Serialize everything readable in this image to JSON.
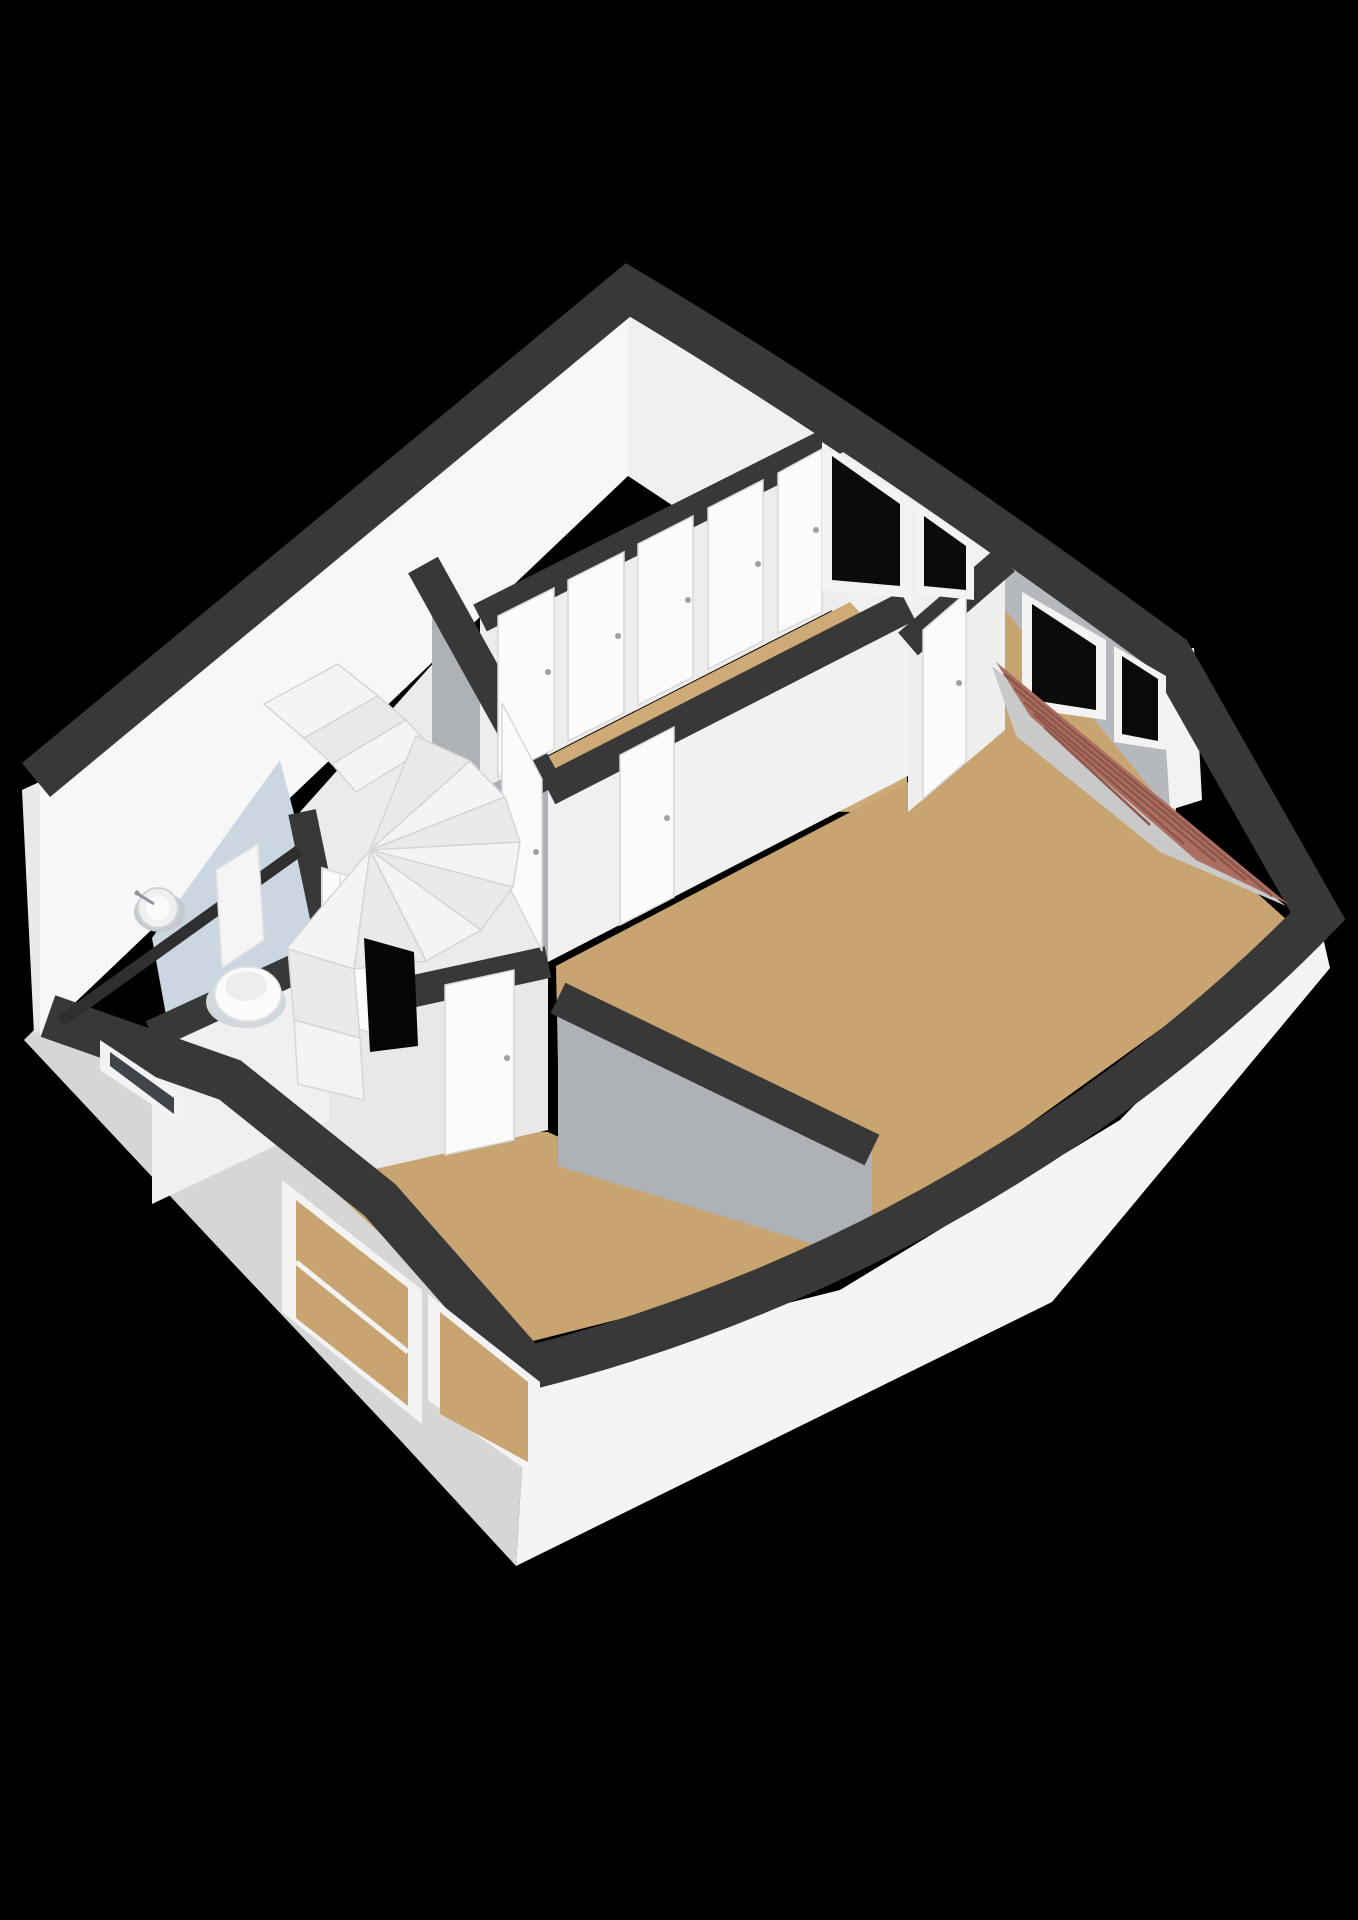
{
  "meta": {
    "type": "3d-floorplan-isometric-render",
    "background": "#000000",
    "floor_label": "upper floor (stairs, landing, bedrooms, toilet)",
    "rooms": [
      {
        "name": "hallway-landing",
        "floor_color": "#cdaa76"
      },
      {
        "name": "ne-bedroom",
        "floor_color": "#c8a470"
      },
      {
        "name": "east-bedroom",
        "floor_color": "#c8a470"
      },
      {
        "name": "south-bedroom",
        "floor_color": "#c8a470"
      },
      {
        "name": "stair-room",
        "floor_color": "#ebebeb"
      },
      {
        "name": "toilet-room",
        "floor_color": "#ccd6e0"
      }
    ],
    "fixtures": [
      "winder-staircase",
      "stairwell-opening",
      "toilet",
      "wall-basin",
      "roof-slope-tiles"
    ],
    "palette": {
      "wall_top_band": "#383838",
      "interior_wall_white": "#f7f7f7",
      "interior_wall_gray": "#aeb1b6",
      "exterior_wall_light": "#d6d6d6",
      "exterior_wall_white": "#f4f4f4",
      "floor_wood": "#c8a470",
      "floor_bath": "#ccd6e0",
      "window_pane": "#0b0b0b",
      "window_frame": "#f3f3f3",
      "roof_tiles": "#ab6e61",
      "roof_tile_line": "#8e564b",
      "door_white": "#fbfbfb",
      "handle_gray": "#9aa0a4"
    }
  },
  "scene": {
    "width": 1358,
    "height": 1920,
    "shapes": [
      {
        "n": "exterior-wall-sw-face",
        "t": "p",
        "f": "#d6d6d6",
        "d": "48,1016 230,1080 380,1200 528,1368 516,1566 400,1440 230,1260 24,1040"
      },
      {
        "n": "exterior-wall-se-face",
        "t": "p",
        "f": "#f4f4f4",
        "d": "528,1368 840,1290 1120,1120 1318,916 1330,968 1052,1302 516,1566"
      },
      {
        "n": "west-corner-wall-cap",
        "t": "p",
        "f": "#e9e9e9",
        "d": "22,790 48,778 62,1018 34,1034"
      },
      {
        "n": "nw-wall-interior-face",
        "t": "p",
        "f": "#f7f7f7",
        "d": "628,300 40,786 40,1036 628,476"
      },
      {
        "n": "ne-wall-interior-face-hall",
        "t": "p",
        "f": "#f0f0f1",
        "d": "628,300 1000,548 1000,722 628,476"
      },
      {
        "n": "ne-wall-interior-face-east-room",
        "t": "p",
        "f": "#b5b8bc",
        "d": "1000,548 1176,660 1176,818 1000,722"
      },
      {
        "n": "east-jut-wall-cap",
        "t": "p",
        "f": "#f2f2f2",
        "d": "1160,650 1194,648 1202,800 1170,810"
      },
      {
        "n": "floor-hallway",
        "t": "p",
        "f": "#cdaa76",
        "d": "482,790 850,602 903,658 908,814 548,802 440,650"
      },
      {
        "n": "floor-ne-bedroom",
        "t": "p",
        "f": "#c8a470",
        "d": "916,662 1002,606 1176,820 1080,880 916,820"
      },
      {
        "n": "floor-east-bedroom",
        "t": "p",
        "f": "#c8a470",
        "d": "556,966 908,782 1000,726 1176,820 1298,930 838,1262 560,1166"
      },
      {
        "n": "floor-south-bedroom",
        "t": "p",
        "f": "#c8a470",
        "d": "178,1048 318,1122 548,1132 838,1264 505,1348"
      },
      {
        "n": "floor-toilet",
        "t": "p",
        "f": "#ccd6e0",
        "d": "152,938 280,760 330,952 168,1026"
      },
      {
        "n": "floor-stair-room",
        "t": "p",
        "f": "#ebebeb",
        "d": "300,812 436,660 548,794 548,960 330,1006"
      },
      {
        "n": "stair-room-gray-wall",
        "t": "p",
        "f": "#aeb1b6",
        "d": "432,570 548,790 548,962 432,744"
      },
      {
        "n": "hallway-se-wall-face",
        "t": "p",
        "f": "#f1f1f1",
        "d": "548,790 908,606 908,776 548,962"
      },
      {
        "n": "hall-nebedroom-partition-face",
        "t": "p",
        "f": "#eeeeee",
        "d": "908,642 1005,560 1005,730 908,812"
      },
      {
        "n": "hallway-closet-wall-face",
        "t": "p",
        "f": "#ededed",
        "d": "480,618 848,432 848,602 480,790"
      },
      {
        "n": "south-bedroom-ne-wall-gray",
        "t": "p",
        "f": "#aeb1b6",
        "d": "558,996 872,1150 872,1262 558,1166"
      },
      {
        "n": "stair-southbedroom-wall-face",
        "t": "p",
        "f": "#e8e8e8",
        "d": "318,1012 548,960 548,1130 318,1182"
      },
      {
        "n": "toilet-se-wall-face",
        "t": "p",
        "f": "#f0f0f0",
        "d": "152,1036 330,952 330,1120 152,1204"
      },
      {
        "n": "wall-top-band-outer",
        "t": "pa",
        "f": "none",
        "s": "#383838",
        "w": 44,
        "d": "M36,780 L628,290 C810,398 1000,530 1170,655 L1318,916 C1120,1120 840,1290 528,1368 L380,1200 L230,1080 L48,1016"
      },
      {
        "n": "wall-top-band-stair-gray-wall",
        "t": "l",
        "s": "#383838",
        "w": 34,
        "d": "423,565 548,790"
      },
      {
        "n": "wall-top-band-closet-wall",
        "t": "l",
        "s": "#383838",
        "w": 30,
        "d": "480,618 850,432"
      },
      {
        "n": "wall-top-band-hallway-se",
        "t": "l",
        "s": "#383838",
        "w": 32,
        "d": "548,790 908,606"
      },
      {
        "n": "wall-top-band-hall-nebed-partition",
        "t": "l",
        "s": "#383838",
        "w": 30,
        "d": "908,644 1005,560"
      },
      {
        "n": "wall-top-band-southbed-ne",
        "t": "l",
        "s": "#383838",
        "w": 34,
        "d": "558,998 872,1150"
      },
      {
        "n": "wall-top-band-stair-southbed",
        "t": "l",
        "s": "#383838",
        "w": 32,
        "d": "318,1012 548,962"
      },
      {
        "n": "wall-top-band-toilet-stair",
        "t": "l",
        "s": "#383838",
        "w": 28,
        "d": "302,812 332,956"
      },
      {
        "n": "wall-top-band-toilet-se",
        "t": "l",
        "s": "#383838",
        "w": 30,
        "d": "152,1035 332,952"
      },
      {
        "n": "baseboard-seam-nw",
        "t": "l",
        "s": "#2f2f2f",
        "w": 12,
        "d": "60,1022 300,850"
      },
      {
        "n": "closet-door-panel-1",
        "t": "p",
        "f": "#fbfbfb",
        "s": "#d8d8d8",
        "w": 1.5,
        "d": "498,616 554,588 554,749 498,777"
      },
      {
        "n": "closet-door-panel-2",
        "t": "p",
        "f": "#fbfbfb",
        "s": "#d8d8d8",
        "w": 1.5,
        "d": "568,580 624,552 624,713 568,741"
      },
      {
        "n": "closet-door-panel-3",
        "t": "p",
        "f": "#fbfbfb",
        "s": "#d8d8d8",
        "w": 1.5,
        "d": "638,544 693,516 693,677 638,705"
      },
      {
        "n": "closet-door-panel-4",
        "t": "p",
        "f": "#fbfbfb",
        "s": "#d8d8d8",
        "w": 1.5,
        "d": "708,508 763,480 763,641 708,669"
      },
      {
        "n": "closet-door-panel-5",
        "t": "p",
        "f": "#fbfbfb",
        "s": "#d8d8d8",
        "w": 1.5,
        "d": "778,473 822,449 822,612 778,633"
      },
      {
        "n": "closet-door-handle-1",
        "t": "c",
        "f": "#9aa0a4",
        "d": "548,672,3"
      },
      {
        "n": "closet-door-handle-2",
        "t": "c",
        "f": "#9aa0a4",
        "d": "618,636,3"
      },
      {
        "n": "closet-door-handle-3",
        "t": "c",
        "f": "#9aa0a4",
        "d": "688,600,3"
      },
      {
        "n": "closet-door-handle-4",
        "t": "c",
        "f": "#9aa0a4",
        "d": "758,564,3"
      },
      {
        "n": "closet-door-handle-5",
        "t": "c",
        "f": "#9aa0a4",
        "d": "816,530,3"
      },
      {
        "n": "door-east-bedroom",
        "t": "p",
        "f": "#fbfbfb",
        "s": "#d8d8d8",
        "w": 1.5,
        "d": "620,755 674,727 674,897 620,925"
      },
      {
        "n": "door-east-bedroom-handle",
        "t": "c",
        "f": "#9aa0a4",
        "d": "667,818,3"
      },
      {
        "n": "door-stair-room",
        "t": "p",
        "f": "#fbfbfb",
        "s": "#d8d8d8",
        "w": 1.5,
        "d": "502,703 542,779 542,951 502,873"
      },
      {
        "n": "door-stair-room-handle",
        "t": "c",
        "f": "#9aa0a4",
        "d": "536,852,3"
      },
      {
        "n": "door-ne-bedroom",
        "t": "p",
        "f": "#fbfbfb",
        "s": "#d8d8d8",
        "w": 1.5,
        "d": "923,630 966,593 966,762 923,799"
      },
      {
        "n": "door-ne-bedroom-handle",
        "t": "c",
        "f": "#9aa0a4",
        "d": "959,683,3"
      },
      {
        "n": "door-south-bedroom",
        "t": "p",
        "f": "#fbfbfb",
        "s": "#d8d8d8",
        "w": 1.5,
        "d": "445,985 514,970 514,1140 445,1155"
      },
      {
        "n": "door-south-bedroom-handle",
        "t": "c",
        "f": "#9aa0a4",
        "d": "507,1058,3"
      },
      {
        "n": "door-toilet-ajar",
        "t": "p",
        "f": "#fbfbfb",
        "s": "#dddddd",
        "w": 2,
        "d": "322,868 396,890 396,1042 322,1016"
      },
      {
        "n": "door-toilet-groove-1",
        "t": "l",
        "s": "#e3e3e3",
        "w": 2,
        "d": "340,876 340,1022"
      },
      {
        "n": "door-toilet-groove-2",
        "t": "l",
        "s": "#e3e3e3",
        "w": 2,
        "d": "378,887 378,1034"
      },
      {
        "n": "door-toilet-handle",
        "t": "c",
        "f": "#9aa0a4",
        "d": "388,962,3"
      },
      {
        "n": "window-hallway-frame",
        "t": "p",
        "f": "#f3f3f3",
        "d": "822,442 910,500 910,598 822,590"
      },
      {
        "n": "window-hallway-pane",
        "t": "p",
        "f": "#0b0b0b",
        "d": "832,456 900,504 900,586 832,580"
      },
      {
        "n": "window-ne-bedroom-frame",
        "t": "p",
        "f": "#f3f3f3",
        "d": "916,504 974,542 974,600 916,594"
      },
      {
        "n": "window-ne-bedroom-pane",
        "t": "p",
        "f": "#0b0b0b",
        "d": "924,516 966,546 966,590 924,586"
      },
      {
        "n": "window-east-jut-big-frame",
        "t": "p",
        "f": "#f3f3f3",
        "d": "1022,592 1106,640 1106,720 1022,708"
      },
      {
        "n": "window-east-jut-big-pane",
        "t": "p",
        "f": "#0b0b0b",
        "d": "1032,604 1096,646 1096,710 1032,700"
      },
      {
        "n": "window-east-jut-small-frame",
        "t": "p",
        "f": "#f3f3f3",
        "d": "1114,646 1166,676 1166,750 1114,742"
      },
      {
        "n": "window-east-jut-small-pane",
        "t": "p",
        "f": "#0b0b0b",
        "d": "1122,656 1158,679 1158,741 1122,734"
      },
      {
        "n": "window-sw-bedroom-1-frame",
        "t": "p",
        "f": "#f3f3f3",
        "d": "282,1180 422,1290 422,1424 282,1312"
      },
      {
        "n": "window-sw-bedroom-1-inner",
        "t": "p",
        "f": "#c8a470",
        "d": "296,1200 408,1288 408,1406 296,1318"
      },
      {
        "n": "window-sw-bedroom-1-transom",
        "t": "l",
        "s": "#f3f3f3",
        "w": 5,
        "d": "296,1262 408,1352"
      },
      {
        "n": "window-sw-bedroom-2-frame",
        "t": "p",
        "f": "#f3f3f3",
        "d": "428,1294 540,1382 540,1480 428,1400"
      },
      {
        "n": "window-sw-bedroom-2-inner",
        "t": "p",
        "f": "#c8a470",
        "d": "440,1312 528,1382 528,1462 440,1414"
      },
      {
        "n": "window-toilet-frame",
        "t": "p",
        "f": "#f3f3f3",
        "d": "100,1040 184,1096 184,1126 100,1070"
      },
      {
        "n": "window-toilet-pane",
        "t": "p",
        "f": "#41454b",
        "d": "110,1052 174,1098 174,1114 110,1066"
      },
      {
        "n": "roof-slope-side",
        "t": "p",
        "f": "#c9c9c9",
        "d": "992,666 1286,906 1160,852 1016,736"
      },
      {
        "n": "roof-slope-tiles",
        "t": "p",
        "f": "#ab6e61",
        "d": "996,662 1288,904 1196,860 1030,716"
      },
      {
        "n": "roof-tile-line-1",
        "t": "l",
        "s": "#8e564b",
        "w": 2.5,
        "d": "1004,674 1272,896"
      },
      {
        "n": "roof-tile-line-2",
        "t": "l",
        "s": "#8e564b",
        "w": 2.5,
        "d": "1014,688 1246,880"
      },
      {
        "n": "roof-tile-line-3",
        "t": "l",
        "s": "#8e564b",
        "w": 2.5,
        "d": "1024,702 1216,862"
      },
      {
        "n": "roof-tile-line-4",
        "t": "l",
        "s": "#8e564b",
        "w": 2.5,
        "d": "1034,714 1184,844"
      },
      {
        "n": "roof-tile-line-5",
        "t": "l",
        "s": "#8e564b",
        "w": 2.5,
        "d": "1044,727 1150,825"
      },
      {
        "n": "stair-top-step-1",
        "t": "p",
        "f": "#f4f4f4",
        "s": "#d3d5d7",
        "w": 1.5,
        "d": "264,704 338,664 378,696 304,738"
      },
      {
        "n": "stair-top-step-2",
        "t": "p",
        "f": "#e9eaeb",
        "s": "#d3d5d7",
        "w": 1.5,
        "d": "304,738 378,696 406,720 332,764"
      },
      {
        "n": "stair-top-step-3",
        "t": "p",
        "f": "#f4f4f4",
        "s": "#d3d5d7",
        "w": 1.5,
        "d": "332,764 406,720 430,746 356,792"
      },
      {
        "n": "stair-winder-1",
        "t": "p",
        "f": "#e9eaeb",
        "s": "#d3d5d7",
        "w": 1.5,
        "d": "370,850 416,736 470,761"
      },
      {
        "n": "stair-winder-2",
        "t": "p",
        "f": "#f4f4f4",
        "s": "#d3d5d7",
        "w": 1.5,
        "d": "370,850 470,761 505,797"
      },
      {
        "n": "stair-winder-3",
        "t": "p",
        "f": "#e9eaeb",
        "s": "#d3d5d7",
        "w": 1.5,
        "d": "370,850 505,797 520,842"
      },
      {
        "n": "stair-winder-4",
        "t": "p",
        "f": "#f4f4f4",
        "s": "#d3d5d7",
        "w": 1.5,
        "d": "370,850 520,842 513,887"
      },
      {
        "n": "stair-winder-5",
        "t": "p",
        "f": "#e9eaeb",
        "s": "#d3d5d7",
        "w": 1.5,
        "d": "370,850 513,887 481,930"
      },
      {
        "n": "stair-winder-6",
        "t": "p",
        "f": "#f4f4f4",
        "s": "#d3d5d7",
        "w": 1.5,
        "d": "370,850 481,930 426,961"
      },
      {
        "n": "stair-winder-7",
        "t": "p",
        "f": "#e9eaeb",
        "s": "#d3d5d7",
        "w": 1.5,
        "d": "370,850 426,961 354,969"
      },
      {
        "n": "stair-winder-8",
        "t": "p",
        "f": "#f4f4f4",
        "s": "#d3d5d7",
        "w": 1.5,
        "d": "370,850 354,969 286,949"
      },
      {
        "n": "stairwell-opening",
        "t": "p",
        "f": "#050505",
        "d": "364,938 414,952 418,1046 370,1052"
      },
      {
        "n": "stair-bottom-step-1",
        "t": "p",
        "f": "#e9eaeb",
        "s": "#d3d5d7",
        "w": 1.5,
        "d": "288,949 354,969 360,1038 294,1020"
      },
      {
        "n": "stair-bottom-step-2",
        "t": "p",
        "f": "#f4f4f4",
        "s": "#d3d5d7",
        "w": 1.5,
        "d": "294,1020 360,1038 364,1100 298,1084"
      },
      {
        "n": "basin-shadow",
        "t": "e",
        "f": "#c6cad0",
        "d": "160,912,26,20"
      },
      {
        "n": "wall-basin",
        "t": "c",
        "f": "#eef0f2",
        "s": "#d0d3d6",
        "w": 2,
        "d": "158,908,20"
      },
      {
        "n": "wall-basin-bowl",
        "t": "c",
        "f": "#fafafa",
        "d": "158,908,12"
      },
      {
        "n": "basin-faucet",
        "t": "l",
        "s": "#8f9296",
        "w": 3,
        "d": "138,894 154,904"
      },
      {
        "n": "basin-faucet-head",
        "t": "c",
        "f": "#8f9296",
        "d": "137,893,2.5"
      },
      {
        "n": "toilet-shadow",
        "t": "e",
        "f": "#d2d7dd",
        "d": "246,1002,40,26"
      },
      {
        "n": "toilet-cistern",
        "t": "p",
        "f": "#f5f5f5",
        "s": "#e0e0e0",
        "w": 1.5,
        "d": "216,870 258,844 264,940 222,968"
      },
      {
        "n": "toilet-bowl",
        "t": "e",
        "f": "#fbfbfb",
        "s": "#e4e4e4",
        "w": 1.5,
        "d": "248,994,33,27"
      },
      {
        "n": "toilet-seat",
        "t": "e",
        "f": "#ebedee",
        "d": "246,986,21,15"
      }
    ]
  }
}
